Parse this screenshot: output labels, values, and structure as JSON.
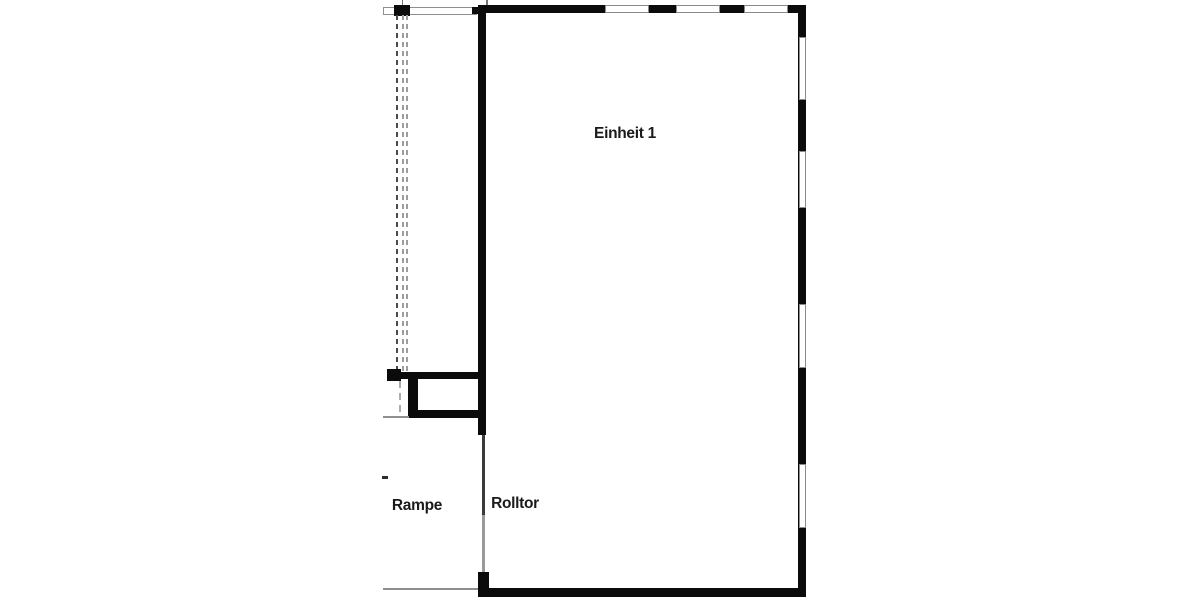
{
  "title": "Grundriss",
  "labels": {
    "unit": "Einheit 1",
    "ramp": "Rampe",
    "roller_door": "Rolltor"
  },
  "colors": {
    "wall": "#0b0b0b",
    "gray_line": "#8f8f8f",
    "window_outline": "#8a8a8a",
    "dashed_dark": "#4a4a4a",
    "dashed_light": "#9e9e9e",
    "text": "#1a1a1a",
    "background": "#ffffff"
  },
  "structure": {
    "room_name": "Einheit 1",
    "windows_top_wall": 3,
    "windows_right_wall": 4,
    "roller_door_location": "left wall, lower section",
    "ramp_location": "left of unit"
  }
}
